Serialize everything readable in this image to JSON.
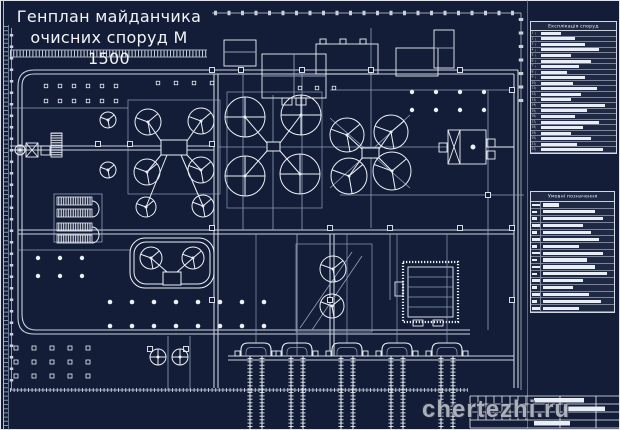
{
  "colors": {
    "background": "#131d37",
    "frame": "#dfe4ee",
    "line": "#c9d1df",
    "line_bright": "#edf1f7",
    "line_dim": "#8fa0bb",
    "text_bar": "#e8edf6",
    "watermark": "#b6bac3"
  },
  "title": {
    "line1": "Генплан майданчика",
    "line2": "очисних споруд М 1500"
  },
  "legend_top": {
    "header": "Експлікація споруд",
    "rows": [
      {
        "n": 1,
        "w": 20
      },
      {
        "n": 2,
        "w": 34
      },
      {
        "n": 3,
        "w": 44
      },
      {
        "n": 4,
        "w": 58
      },
      {
        "n": 5,
        "w": 30
      },
      {
        "n": 6,
        "w": 50
      },
      {
        "n": 7,
        "w": 38
      },
      {
        "n": 8,
        "w": 26
      },
      {
        "n": 9,
        "w": 44
      },
      {
        "n": 10,
        "w": 32
      },
      {
        "n": 11,
        "w": 56
      },
      {
        "n": 12,
        "w": 40
      },
      {
        "n": 13,
        "w": 30
      },
      {
        "n": 14,
        "w": 64
      },
      {
        "n": 15,
        "w": 46
      },
      {
        "n": 16,
        "w": 34
      },
      {
        "n": 17,
        "w": 58
      },
      {
        "n": 18,
        "w": 42
      },
      {
        "n": 19,
        "w": 30
      },
      {
        "n": 20,
        "w": 50
      },
      {
        "n": 21,
        "w": 36
      },
      {
        "n": 22,
        "w": 62
      },
      {
        "n": 23,
        "w": 44
      },
      {
        "n": 24,
        "w": 32
      },
      {
        "n": 25,
        "w": 54
      },
      {
        "n": 26,
        "w": 66
      },
      {
        "n": 27,
        "w": 46
      }
    ]
  },
  "legend_bottom": {
    "header": "Умовні позначення",
    "rows": [
      {
        "s": 18,
        "w": 16
      },
      {
        "s": 5,
        "w": 52
      },
      {
        "s": 5,
        "w": 60
      },
      {
        "s": 8,
        "w": 40
      },
      {
        "s": 5,
        "w": 48
      },
      {
        "s": 8,
        "w": 56
      },
      {
        "s": 5,
        "w": 36
      },
      {
        "s": 8,
        "w": 60
      },
      {
        "s": 5,
        "w": 44
      },
      {
        "s": 8,
        "w": 52
      },
      {
        "s": 5,
        "w": 64
      },
      {
        "s": 8,
        "w": 40
      },
      {
        "s": 5,
        "w": 30
      },
      {
        "s": 8,
        "w": 46
      },
      {
        "s": 5,
        "w": 58
      },
      {
        "s": 8,
        "w": 36
      },
      {
        "s": 5,
        "w": 50
      },
      {
        "s": 8,
        "w": 28
      },
      {
        "s": 5,
        "w": 56
      }
    ]
  },
  "watermark": {
    "text": "chertezhi.ru"
  },
  "plan": {
    "tree_grids": [
      {
        "shape": "square",
        "x0": 46,
        "dx": 14,
        "nx": 6,
        "ys": [
          86,
          101
        ],
        "size": 3.5
      },
      {
        "shape": "circle",
        "x0": 412,
        "dx": 24,
        "nx": 4,
        "ys": [
          92,
          110
        ],
        "size": 2.2
      },
      {
        "shape": "square",
        "x0": 16,
        "dx": 18,
        "nx": 5,
        "ys": [
          348,
          362,
          376
        ],
        "size": 4
      },
      {
        "shape": "circle",
        "x0": 110,
        "dx": 22,
        "nx": 8,
        "ys": [
          302,
          326
        ],
        "size": 2.3
      },
      {
        "shape": "square",
        "x0": 158,
        "dx": 18,
        "nx": 4,
        "ys": [
          83
        ],
        "size": 3.5
      },
      {
        "shape": "square",
        "x0": 300,
        "dx": 17,
        "nx": 3,
        "ys": [
          88
        ],
        "size": 3.5
      },
      {
        "shape": "circle",
        "x0": 38,
        "dx": 22,
        "nx": 3,
        "ys": [
          258,
          276
        ],
        "size": 2.2
      }
    ],
    "nodes": [
      [
        212,
        70
      ],
      [
        212,
        144
      ],
      [
        212,
        228
      ],
      [
        212,
        300
      ],
      [
        241,
        70
      ],
      [
        302,
        70
      ],
      [
        371,
        70
      ],
      [
        460,
        70
      ],
      [
        330,
        228
      ],
      [
        390,
        228
      ],
      [
        460,
        228
      ],
      [
        512,
        228
      ],
      [
        130,
        144
      ],
      [
        98,
        144
      ],
      [
        330,
        300
      ],
      [
        512,
        300
      ],
      [
        150,
        349
      ],
      [
        186,
        349
      ],
      [
        512,
        90
      ],
      [
        488,
        195
      ]
    ],
    "sludge_beds": {
      "centers": [
        256,
        297,
        347,
        397,
        447
      ],
      "top": 343,
      "bottom": 430
    },
    "clarifiers": [
      {
        "cx": 148,
        "cy": 122,
        "r": 13,
        "k": "spokes"
      },
      {
        "cx": 201,
        "cy": 121,
        "r": 13,
        "k": "spokes"
      },
      {
        "cx": 147,
        "cy": 172,
        "r": 13,
        "k": "spokes"
      },
      {
        "cx": 201,
        "cy": 170,
        "r": 13,
        "k": "spokes"
      },
      {
        "cx": 146,
        "cy": 207,
        "r": 10,
        "k": "spokes"
      },
      {
        "cx": 203,
        "cy": 206,
        "r": 11,
        "k": "spokes"
      },
      {
        "cx": 108,
        "cy": 120,
        "r": 8,
        "k": "spokes"
      },
      {
        "cx": 108,
        "cy": 170,
        "r": 8,
        "k": "spokes"
      },
      {
        "cx": 245,
        "cy": 117,
        "r": 20,
        "k": "cross"
      },
      {
        "cx": 301,
        "cy": 115,
        "r": 20,
        "k": "cross"
      },
      {
        "cx": 245,
        "cy": 176,
        "r": 20,
        "k": "cross"
      },
      {
        "cx": 300,
        "cy": 174,
        "r": 20,
        "k": "cross"
      },
      {
        "cx": 347,
        "cy": 135,
        "r": 17,
        "k": "spokes"
      },
      {
        "cx": 391,
        "cy": 132,
        "r": 17,
        "k": "spokes"
      },
      {
        "cx": 349,
        "cy": 176,
        "r": 18,
        "k": "spokes"
      },
      {
        "cx": 392,
        "cy": 171,
        "r": 19,
        "k": "spokes"
      },
      {
        "cx": 151,
        "cy": 258,
        "r": 11,
        "k": "spokes"
      },
      {
        "cx": 193,
        "cy": 258,
        "r": 11,
        "k": "spokes"
      },
      {
        "cx": 333,
        "cy": 269,
        "r": 13,
        "k": "spokes"
      },
      {
        "cx": 332,
        "cy": 306,
        "r": 12,
        "k": "spokes"
      },
      {
        "cx": 158,
        "cy": 357,
        "r": 8,
        "k": "cross"
      },
      {
        "cx": 180,
        "cy": 357,
        "r": 8,
        "k": "cross"
      },
      {
        "cx": 20,
        "cy": 150,
        "r": 5,
        "k": "cross"
      }
    ]
  }
}
